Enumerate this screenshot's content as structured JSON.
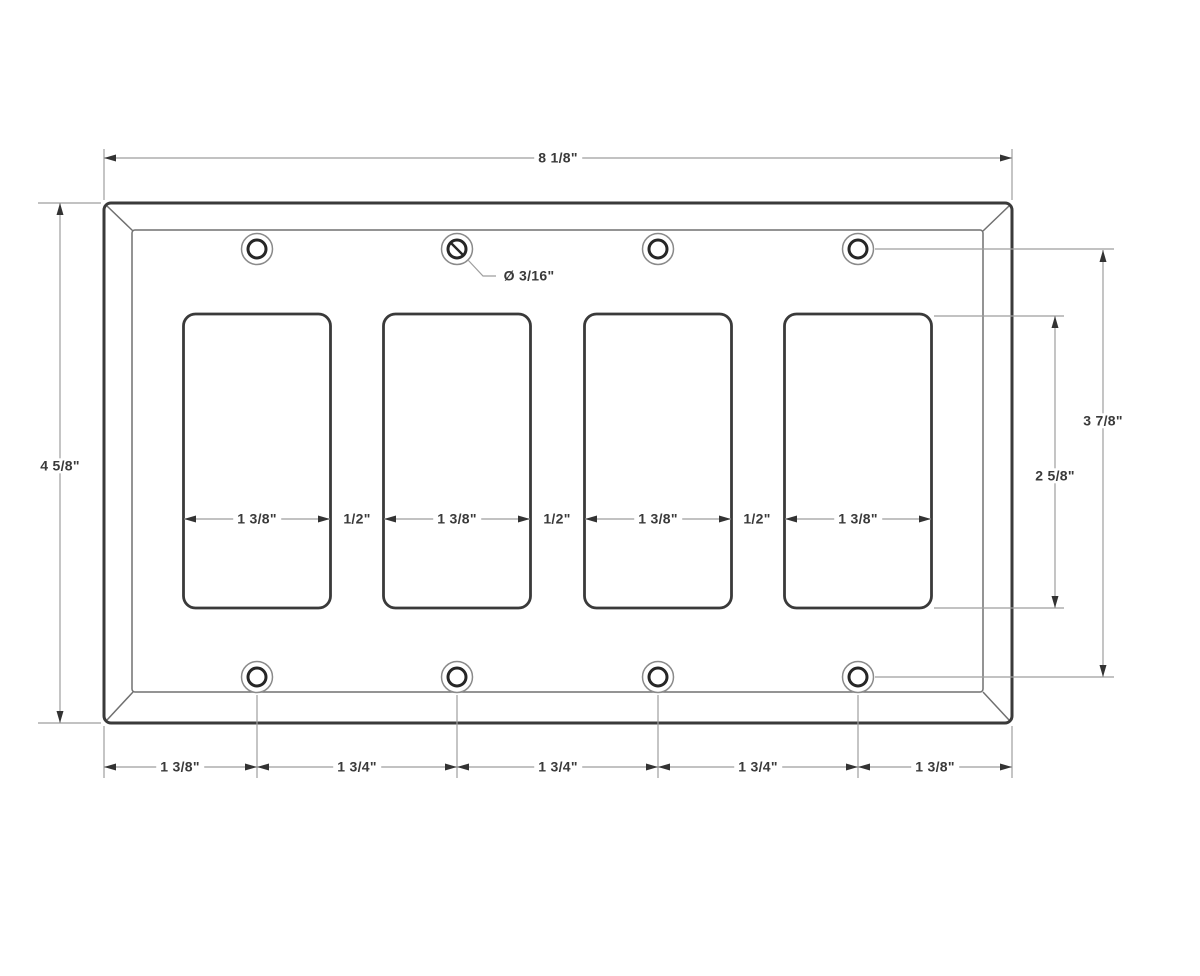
{
  "diagram": {
    "overall_width": "8 1/8\"",
    "overall_height": "4 5/8\"",
    "screw_span": "3 7/8\"",
    "opening_height": "2 5/8\"",
    "hole_diameter": "Ø 3/16\"",
    "opening_widths": [
      "1 3/8\"",
      "1 3/8\"",
      "1 3/8\"",
      "1 3/8\""
    ],
    "opening_gaps": [
      "1/2\"",
      "1/2\"",
      "1/2\""
    ],
    "bottom_chain": [
      "1 3/8\"",
      "1 3/4\"",
      "1 3/4\"",
      "1 3/4\"",
      "1 3/8\""
    ],
    "colors": {
      "background": "#ffffff",
      "outline": "#3a3a3a",
      "bevel_line": "#707070",
      "dimension_line": "#9e9e9e",
      "arrowhead": "#333333",
      "text": "#3a3a3a"
    }
  }
}
